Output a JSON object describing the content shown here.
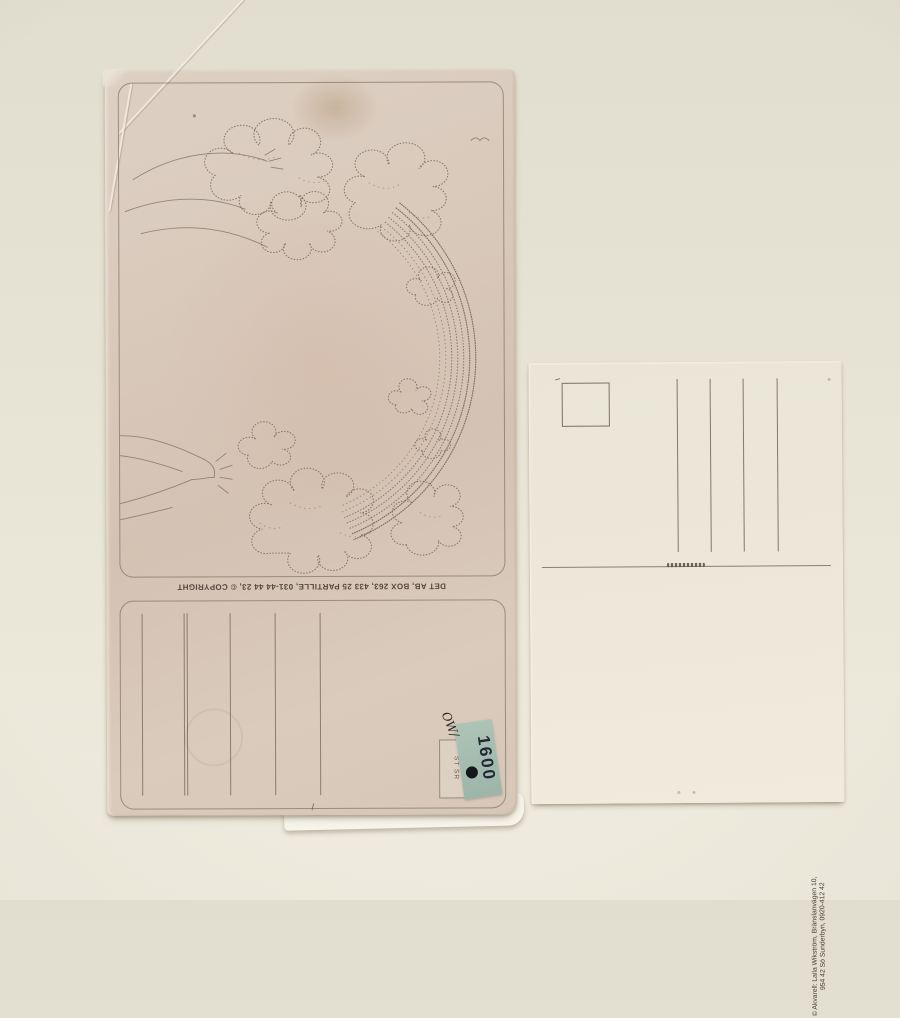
{
  "left_card": {
    "publisher_line": "DET AB, BOX 263, 433 25 PARTILLE, 031-44 44 23, © COPYRIGHT",
    "stock_label": "ST SR",
    "price_sticker": {
      "price": "1600",
      "handwritten_mark": "OW/",
      "sticker_color": "#a6beb1"
    },
    "artwork_subject": "stippled-drawing-clouds-trees-rainbow"
  },
  "right_card": {
    "copyright_line_1": "© Akvarell: Laila Wikström, Bränslanvägen 10,",
    "copyright_line_2": "954 42 Sö Sunderbyn, 0920-412 42"
  },
  "colors": {
    "wall": "#e8e4d6",
    "left_card_paper": "#d8c8ba",
    "right_card_paper": "#ece7d9",
    "sticker_teal": "#a6beb1"
  }
}
